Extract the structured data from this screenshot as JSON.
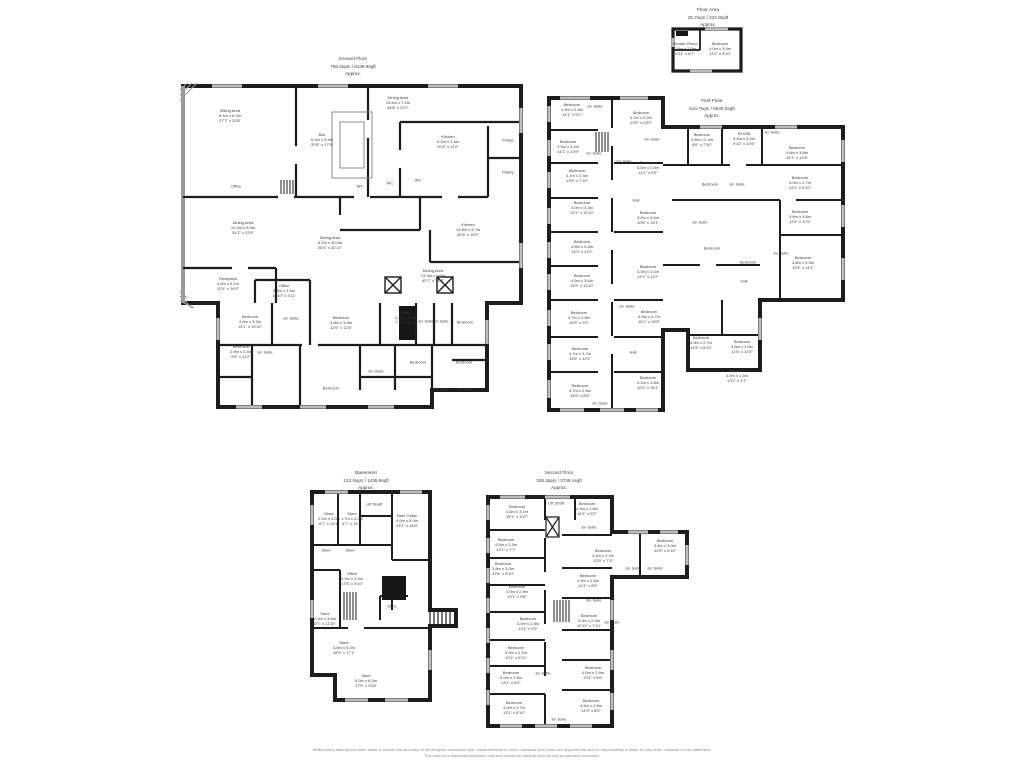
{
  "colors": {
    "wall": "#1c1c1c",
    "window": "#bdbdbd",
    "text": "#3c3c3c",
    "muted": "#8a8a8a"
  },
  "disclaimer": {
    "line1": "Whilst every attempt has been made to ensure the accuracy of the floorplan contained here, measurements of doors, windows and rooms are approximate and no responsibility is taken for any error, omission or mis-statement.",
    "line2": "This plan is for illustrative purposes only and should be used as such by any prospective purchaser."
  },
  "plans": [
    {
      "id": "ground-floor",
      "title": [
        "Ground Floor",
        "756.2sqm / 8139.8sqft",
        "Approx."
      ],
      "tx": 353,
      "ty": 57,
      "rooms": [
        {
          "n": "Sitting Area",
          "d": "8.4m x 6.3m",
          "f": "27'7\" x 20'8\"",
          "x": 230,
          "y": 116
        },
        {
          "n": "Dining Area",
          "d": "13.6m x 7.2m",
          "f": "44'8\" x 23'7\"",
          "x": 398,
          "y": 103
        },
        {
          "n": "Bar",
          "d": "6.3m x 5.4m",
          "f": "20'8\" x 17'9\"",
          "x": 322,
          "y": 140
        },
        {
          "n": "Kitchen",
          "d": "6.2m x 3.4m",
          "f": "20'4\" x 11'2\"",
          "x": 448,
          "y": 142
        },
        {
          "n": "Fridge",
          "d": "",
          "f": "",
          "x": 508,
          "y": 140
        },
        {
          "n": "Pantry",
          "d": "",
          "f": "",
          "x": 508,
          "y": 172
        },
        {
          "n": "WC",
          "d": "",
          "f": "",
          "x": 360,
          "y": 186
        },
        {
          "n": "WC",
          "d": "",
          "f": "",
          "x": 390,
          "y": 183
        },
        {
          "n": "WC",
          "d": "",
          "f": "",
          "x": 418,
          "y": 180
        },
        {
          "n": "Office",
          "d": "",
          "f": "",
          "x": 236,
          "y": 186
        },
        {
          "n": "Dining Area",
          "d": "10.4m x 6.9m",
          "f": "34'1\" x 22'8\"",
          "x": 243,
          "y": 228
        },
        {
          "n": "Dining Area",
          "d": "6.2m x 10.0m",
          "f": "20'4\" x 32'10\"",
          "x": 330,
          "y": 243
        },
        {
          "n": "Kitchen",
          "d": "13.8m x 4.7m",
          "f": "45'3\" x 15'5\"",
          "x": 468,
          "y": 230
        },
        {
          "n": "Dining Area",
          "d": "13.3m x 9.6m",
          "f": "43'7\" x 31'6\"",
          "x": 433,
          "y": 276
        },
        {
          "n": "Reception",
          "d": "4.0m x 5.1m",
          "f": "13'1\" x 16'9\"",
          "x": 228,
          "y": 284
        },
        {
          "n": "Office",
          "d": "3.3m x 1.5m",
          "f": "10'10\" x 4'11\"",
          "x": 284,
          "y": 291
        },
        {
          "n": "Bedroom",
          "d": "4.0m x 3.3m",
          "f": "13'1\" x 10'10\"",
          "x": 250,
          "y": 322
        },
        {
          "n": "En Suite",
          "d": "",
          "f": "",
          "x": 291,
          "y": 318
        },
        {
          "n": "Bedroom",
          "d": "3.8m x 3.8m",
          "f": "12'6\" x 12'6\"",
          "x": 341,
          "y": 323
        },
        {
          "n": "Office",
          "d": "2.4m x 2.1m",
          "f": "7'10\" x 6'11\"",
          "x": 406,
          "y": 318
        },
        {
          "n": "En Suite",
          "d": "",
          "f": "",
          "x": 426,
          "y": 321
        },
        {
          "n": "En Suite",
          "d": "",
          "f": "",
          "x": 441,
          "y": 321
        },
        {
          "n": "Bedroom",
          "d": "",
          "f": "",
          "x": 465,
          "y": 322
        },
        {
          "n": "Bedroom",
          "d": "2.9m x 3.4m",
          "f": "9'6\" x 11'2\"",
          "x": 241,
          "y": 352
        },
        {
          "n": "En Suite",
          "d": "",
          "f": "",
          "x": 265,
          "y": 352
        },
        {
          "n": "Bedroom",
          "d": "",
          "f": "",
          "x": 418,
          "y": 362
        },
        {
          "n": "Bedroom",
          "d": "",
          "f": "",
          "x": 464,
          "y": 362
        },
        {
          "n": "En Suite",
          "d": "",
          "f": "",
          "x": 376,
          "y": 371
        },
        {
          "n": "Bedroom",
          "d": "",
          "f": "",
          "x": 331,
          "y": 388
        },
        {
          "n": "En Suite",
          "d": "",
          "f": "",
          "x": 441,
          "y": 389
        },
        {
          "n": "En Suite",
          "d": "",
          "f": "",
          "x": 466,
          "y": 389
        }
      ]
    },
    {
      "id": "floor-area",
      "title": [
        "Floor Area",
        "20.7sqm / 222.8sqft",
        "Approx."
      ],
      "tx": 708,
      "ty": 8,
      "rooms": [
        {
          "n": "Shower Room",
          "d": "1.8m x 2.0m",
          "f": "5'11\" x 6'7\"",
          "x": 685,
          "y": 49
        },
        {
          "n": "Bedroom",
          "d": "4.0m x 3.0m",
          "f": "13'1\" x 9'10\"",
          "x": 720,
          "y": 49
        }
      ]
    },
    {
      "id": "first-floor",
      "title": [
        "First Floor",
        "514.7sqm / 5540.2sqft",
        "Approx."
      ],
      "tx": 712,
      "ty": 99,
      "rooms": [
        {
          "n": "Bedroom",
          "d": "4.3m x 2.8m",
          "f": "14'1\" x 9'2\"",
          "x": 572,
          "y": 110
        },
        {
          "n": "En Suite",
          "d": "",
          "f": "",
          "x": 595,
          "y": 106
        },
        {
          "n": "Bedroom",
          "d": "4.2m x 4.2m",
          "f": "13'9\" x 13'9\"",
          "x": 641,
          "y": 118
        },
        {
          "n": "Bedroom",
          "d": "4.3m x 4.2m",
          "f": "14'1\" x 13'9\"",
          "x": 568,
          "y": 147
        },
        {
          "n": "En Suite",
          "d": "",
          "f": "",
          "x": 594,
          "y": 153
        },
        {
          "n": "En Suite",
          "d": "",
          "f": "",
          "x": 652,
          "y": 139
        },
        {
          "n": "Bedroom",
          "d": "2.6m x 2.4m",
          "f": "8'6\" x 7'10\"",
          "x": 702,
          "y": 140
        },
        {
          "n": "ROOM",
          "d": "3.0m x 3.2m",
          "f": "9'10\" x 10'6\"",
          "x": 744,
          "y": 139
        },
        {
          "n": "En Suite",
          "d": "",
          "f": "",
          "x": 772,
          "y": 132
        },
        {
          "n": "Bedroom",
          "d": "4.6m x 3.8m",
          "f": "15'1\" x 12'6\"",
          "x": 797,
          "y": 153
        },
        {
          "n": "Bedroom",
          "d": "4.1m x 2.4m",
          "f": "13'5\" x 7'10\"",
          "x": 577,
          "y": 176
        },
        {
          "n": "Bedroom",
          "d": "3.4m x 2.8m",
          "f": "11'2\" x 9'2\"",
          "x": 648,
          "y": 168
        },
        {
          "n": "En Suite",
          "d": "",
          "f": "",
          "x": 624,
          "y": 161
        },
        {
          "n": "Bedroom",
          "d": "",
          "f": "",
          "x": 710,
          "y": 184
        },
        {
          "n": "En Suite",
          "d": "",
          "f": "",
          "x": 737,
          "y": 184
        },
        {
          "n": "Bedroom",
          "d": "4.0m x 2.7m",
          "f": "13'1\" x 8'10\"",
          "x": 800,
          "y": 183
        },
        {
          "n": "Hall",
          "d": "",
          "f": "",
          "x": 636,
          "y": 200
        },
        {
          "n": "Bedroom",
          "d": "4.0m x 3.3m",
          "f": "13'1\" x 10'10\"",
          "x": 582,
          "y": 208
        },
        {
          "n": "Bedroom",
          "d": "3.2m x 4.0m",
          "f": "10'6\" x 13'1\"",
          "x": 648,
          "y": 218
        },
        {
          "n": "Bedroom",
          "d": "3.8m x 3.8m",
          "f": "12'6\" x 12'6\"",
          "x": 800,
          "y": 217
        },
        {
          "n": "En Suite",
          "d": "",
          "f": "",
          "x": 700,
          "y": 222
        },
        {
          "n": "Bedroom",
          "d": "4.5m x 3.4m",
          "f": "14'9\" x 11'2\"",
          "x": 582,
          "y": 247
        },
        {
          "n": "Bedroom",
          "d": "",
          "f": "",
          "x": 712,
          "y": 248
        },
        {
          "n": "Bedroom",
          "d": "",
          "f": "",
          "x": 748,
          "y": 262
        },
        {
          "n": "En Suite",
          "d": "",
          "f": "",
          "x": 781,
          "y": 253
        },
        {
          "n": "Bedroom",
          "d": "3.8m x 4.3m",
          "f": "12'6\" x 14'1\"",
          "x": 803,
          "y": 263
        },
        {
          "n": "Bedroom",
          "d": "4.5m x 3.6m",
          "f": "14'9\" x 11'10\"",
          "x": 582,
          "y": 281
        },
        {
          "n": "Bedroom",
          "d": "4.3m x 3.4m",
          "f": "14'1\" x 11'2\"",
          "x": 648,
          "y": 272
        },
        {
          "n": "Hall",
          "d": "",
          "f": "",
          "x": 744,
          "y": 281
        },
        {
          "n": "Bedroom",
          "d": "4.7m x 2.8m",
          "f": "15'5\" x 9'2\"",
          "x": 579,
          "y": 318
        },
        {
          "n": "En Suite",
          "d": "",
          "f": "",
          "x": 627,
          "y": 306
        },
        {
          "n": "Bedroom",
          "d": "4.9m x 4.7m",
          "f": "16'1\" x 15'5\"",
          "x": 649,
          "y": 317
        },
        {
          "n": "Bedroom",
          "d": "4.5m x 2.7m",
          "f": "14'9\" x 8'10\"",
          "x": 701,
          "y": 343
        },
        {
          "n": "Bedroom",
          "d": "3.5m x 3.5m",
          "f": "11'6\" x 11'6\"",
          "x": 742,
          "y": 347
        },
        {
          "n": "Bedroom",
          "d": "4.7m x 3.7m",
          "f": "15'5\" x 12'2\"",
          "x": 580,
          "y": 354
        },
        {
          "n": "Hall",
          "d": "",
          "f": "",
          "x": 633,
          "y": 352
        },
        {
          "n": "Bathroom",
          "d": "4.0m x 1.4m",
          "f": "13'1\" x 4'7\"",
          "x": 737,
          "y": 376
        },
        {
          "n": "Bedroom",
          "d": "3.1m x 4.6m",
          "f": "10'2\" x 15'1\"",
          "x": 648,
          "y": 383
        },
        {
          "n": "Bedroom",
          "d": "4.7m x 2.6m",
          "f": "15'5\" x 8'6\"",
          "x": 580,
          "y": 391
        },
        {
          "n": "En Suite",
          "d": "",
          "f": "",
          "x": 600,
          "y": 403
        }
      ]
    },
    {
      "id": "basement",
      "title": [
        "Basement",
        "133.4sqm / 1435.9sqft",
        "Approx."
      ],
      "tx": 366,
      "ty": 471,
      "rooms": [
        {
          "n": "Store",
          "d": "2.0m x 4.0m",
          "f": "6'7\" x 13'1\"",
          "x": 329,
          "y": 519
        },
        {
          "n": "Store",
          "d": "1.7m x 4.0m",
          "f": "5'7\" x 13'1\"",
          "x": 352,
          "y": 519
        },
        {
          "n": "Lift Shaft",
          "d": "",
          "f": "",
          "x": 374,
          "y": 504
        },
        {
          "n": "Beer Cellar",
          "d": "4.0m x 5.0m",
          "f": "13'1\" x 16'5\"",
          "x": 407,
          "y": 521
        },
        {
          "n": "Store",
          "d": "",
          "f": "",
          "x": 326,
          "y": 550
        },
        {
          "n": "Store",
          "d": "",
          "f": "",
          "x": 350,
          "y": 550
        },
        {
          "n": "Office",
          "d": "5.3m x 3.0m",
          "f": "17'5\" x 9'10\"",
          "x": 352,
          "y": 579
        },
        {
          "n": "Store",
          "d": "",
          "f": "",
          "x": 392,
          "y": 606
        },
        {
          "n": "Store",
          "d": "2.0m x 3.6m",
          "f": "6'7\" x 11'10\"",
          "x": 325,
          "y": 619
        },
        {
          "n": "Store",
          "d": "4.8m x 5.2m",
          "f": "15'9\" x 17'1\"",
          "x": 344,
          "y": 648
        },
        {
          "n": "Store",
          "d": "5.3m x 6.3m",
          "f": "17'5\" x 20'8\"",
          "x": 366,
          "y": 681
        }
      ]
    },
    {
      "id": "second-floor",
      "title": [
        "Second Floor",
        "348.3sqm / 3749.1sqft",
        "Approx."
      ],
      "tx": 559,
      "ty": 471,
      "rooms": [
        {
          "n": "Bedroom",
          "d": "4.6m x 3.1m",
          "f": "15'1\" x 10'2\"",
          "x": 517,
          "y": 512
        },
        {
          "n": "Lift Shaft",
          "d": "",
          "f": "",
          "x": 556,
          "y": 503
        },
        {
          "n": "Bedroom",
          "d": "4.3m x 2.8m",
          "f": "14'1\" x 9'2\"",
          "x": 587,
          "y": 509
        },
        {
          "n": "En Suite",
          "d": "",
          "f": "",
          "x": 589,
          "y": 527
        },
        {
          "n": "Bedroom",
          "d": "4.0m x 2.3m",
          "f": "13'1\" x 7'7\"",
          "x": 506,
          "y": 545
        },
        {
          "n": "Bedroom",
          "d": "3.8m x 3.0m",
          "f": "12'6\" x 9'10\"",
          "x": 665,
          "y": 546
        },
        {
          "n": "Bedroom",
          "d": "4.2m x 2.2m",
          "f": "13'9\" x 7'3\"",
          "x": 603,
          "y": 556
        },
        {
          "n": "En Suite",
          "d": "",
          "f": "",
          "x": 633,
          "y": 568
        },
        {
          "n": "En Suite",
          "d": "",
          "f": "",
          "x": 655,
          "y": 568
        },
        {
          "n": "Bedroom",
          "d": "3.8m x 3.0m",
          "f": "12'6\" x 9'10\"",
          "x": 503,
          "y": 569
        },
        {
          "n": "Bedroom",
          "d": "4.0m x 2.9m",
          "f": "13'1\" x 9'6\"",
          "x": 517,
          "y": 592
        },
        {
          "n": "Bedroom",
          "d": "4.3m x 2.6m",
          "f": "14'1\" x 8'6\"",
          "x": 588,
          "y": 581
        },
        {
          "n": "En Suite",
          "d": "",
          "f": "",
          "x": 594,
          "y": 600
        },
        {
          "n": "Bedroom",
          "d": "4.0m x 2.8m",
          "f": "13'1\" x 9'2\"",
          "x": 528,
          "y": 624
        },
        {
          "n": "Bedroom",
          "d": "3.3m x 2.4m",
          "f": "10'10\" x 7'10\"",
          "x": 589,
          "y": 621
        },
        {
          "n": "En Suite",
          "d": "",
          "f": "",
          "x": 612,
          "y": 622
        },
        {
          "n": "Bedroom",
          "d": "4.0m x 2.1m",
          "f": "13'1\" x 6'11\"",
          "x": 516,
          "y": 653
        },
        {
          "n": "Bedroom",
          "d": "4.0m x 2.5m",
          "f": "13'1\" x 8'2\"",
          "x": 511,
          "y": 678
        },
        {
          "n": "En Suite",
          "d": "",
          "f": "",
          "x": 543,
          "y": 673
        },
        {
          "n": "Bedroom",
          "d": "4.0m x 2.6m",
          "f": "13'1\" x 8'6\"",
          "x": 593,
          "y": 673
        },
        {
          "n": "Bedroom",
          "d": "4.0m x 2.7m",
          "f": "13'1\" x 8'10\"",
          "x": 514,
          "y": 708
        },
        {
          "n": "Bedroom",
          "d": "4.5m x 2.5m",
          "f": "14'9\" x 8'2\"",
          "x": 591,
          "y": 706
        },
        {
          "n": "En Suite",
          "d": "",
          "f": "",
          "x": 559,
          "y": 719
        }
      ]
    }
  ]
}
